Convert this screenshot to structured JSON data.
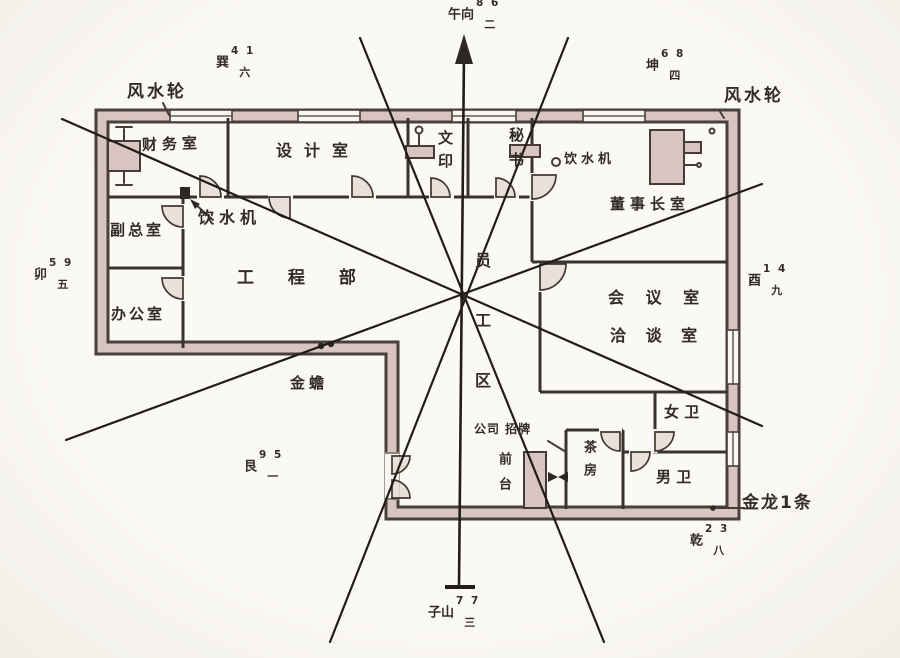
{
  "rooms": {
    "finance": "财务室",
    "design": "设计室",
    "print": "文印",
    "secretary": "秘书",
    "water_dispenser_right": "饮水机",
    "chairman": "董事长室",
    "vice_gm": "副总室",
    "office": "办公室",
    "engineering": "工 程 部",
    "water_dispenser_left": "饮水机",
    "meeting": "会 议 室",
    "negotiation": "洽 谈 室",
    "staff_area": "员工区",
    "womens_wc": "女 卫",
    "mens_wc": "男 卫",
    "tea_room": "茶房",
    "reception": "前台"
  },
  "annotations": {
    "fengshui_wheel_left": "风水轮",
    "fengshui_wheel_right": "风水轮",
    "golden_toad": "金蟾",
    "golden_dragon": "金龙1条",
    "company_sign": "公司 招牌"
  },
  "compass": {
    "top": {
      "label": "午向",
      "stars": "8 6",
      "period": "二"
    },
    "top_left": {
      "label": "巽",
      "stars": "4 1",
      "period": "六"
    },
    "top_right": {
      "label": "坤",
      "stars": "6 8",
      "period": "四"
    },
    "left": {
      "label": "卯",
      "stars": "5 9",
      "period": "五"
    },
    "right": {
      "label": "酉",
      "stars": "1 4",
      "period": "九"
    },
    "bottom_left": {
      "label": "艮",
      "stars": "9 5",
      "period": "一"
    },
    "bottom_right": {
      "label": "乾",
      "stars": "2 3",
      "period": "八"
    },
    "bottom": {
      "label": "子山",
      "stars": "7 7",
      "period": "三"
    }
  },
  "colors": {
    "ink": "#322c27",
    "wall_fill": "#d8c5c1",
    "paper": "#f9f7f2",
    "sector_line": "#211d19"
  }
}
